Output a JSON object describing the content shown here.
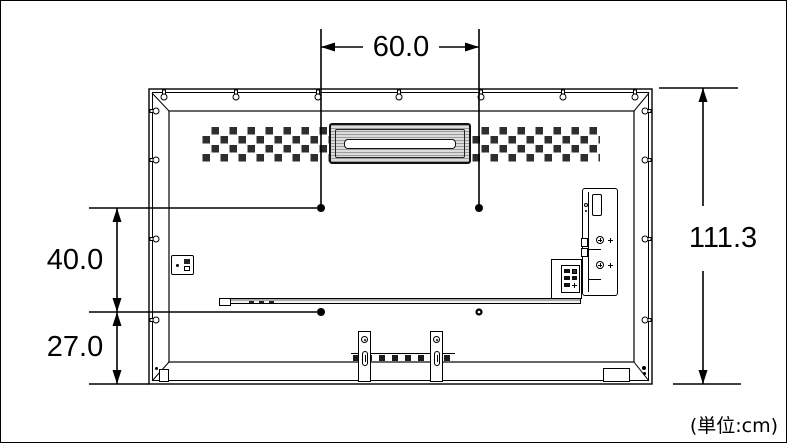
{
  "labels": {
    "mount_hole_width": "60.0",
    "mount_hole_height": "40.0",
    "mount_to_bottom": "27.0",
    "overall_height": "111.3",
    "units_note": "(単位:cm)"
  },
  "colors": {
    "line": "#000000",
    "background": "#ffffff",
    "vent_square": "#2e2e2e",
    "handle_shade": "#d6d6d6"
  }
}
